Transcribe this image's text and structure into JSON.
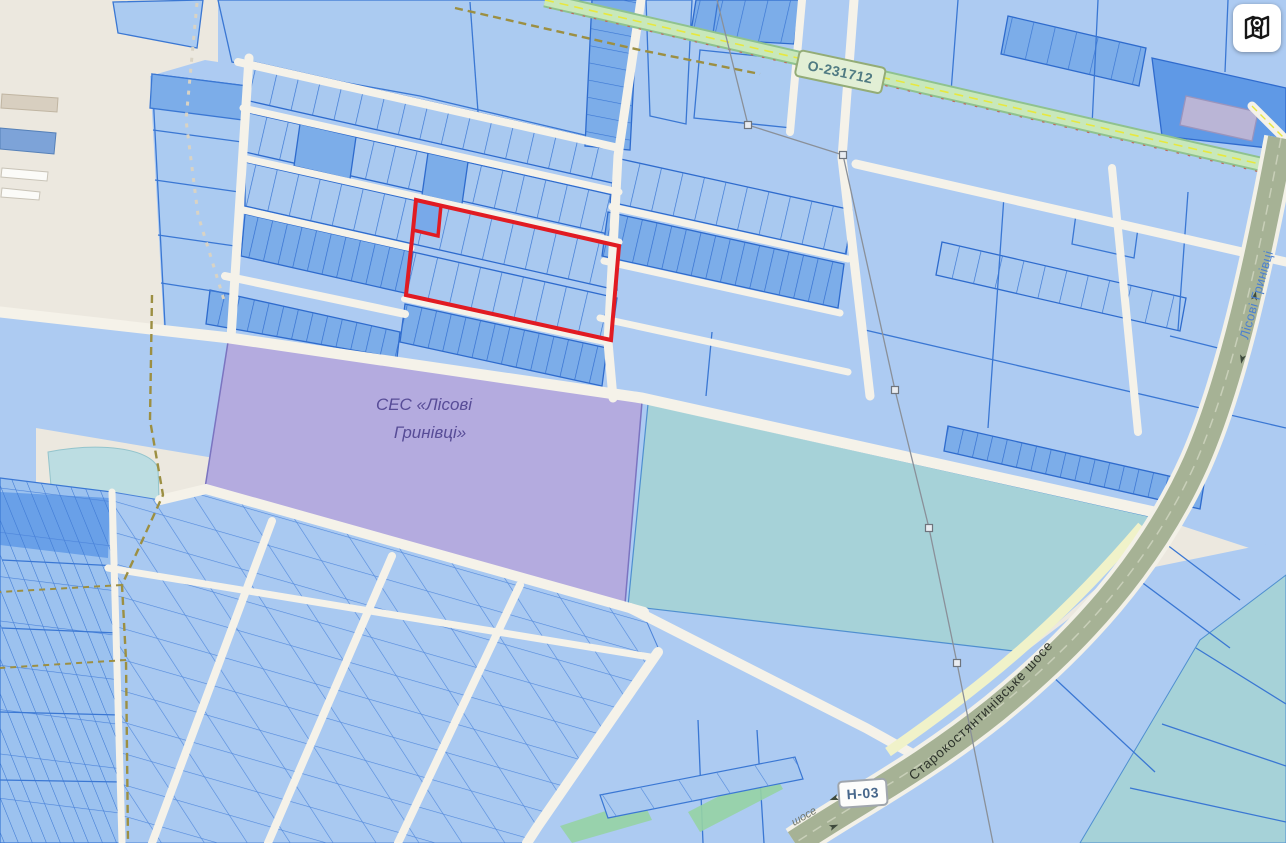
{
  "map": {
    "region_labels": {
      "ses_line1": "СЕС «Лісові",
      "ses_line2": "Гринівці»"
    },
    "road_labels": {
      "o_road": "О-231712",
      "n_road": "Н-03",
      "highway": "Старокостянтинівське шосе",
      "street": "Лісові Гринівці",
      "road_fragment": "шосе"
    },
    "controls": {
      "map_button_icon": "map-location-icon"
    },
    "colors": {
      "background_beige": "#ece8df",
      "parcel_light": "#abcbf1",
      "parcel_medium": "#7cade9",
      "parcel_dark": "#5f99e6",
      "parcel_border": "#3a77d3",
      "selection_red": "#e11b22",
      "ses_area_purple": "#b4abdf",
      "field_teal": "#a6d2d8",
      "pond_teal": "#bcdde2",
      "road_white": "#f5f2e9",
      "road_green": "#bfe3b4",
      "highway_gray_green": "#a6b295",
      "power_line_gray": "#8a9099",
      "trail_olive": "#9c8f42"
    }
  }
}
